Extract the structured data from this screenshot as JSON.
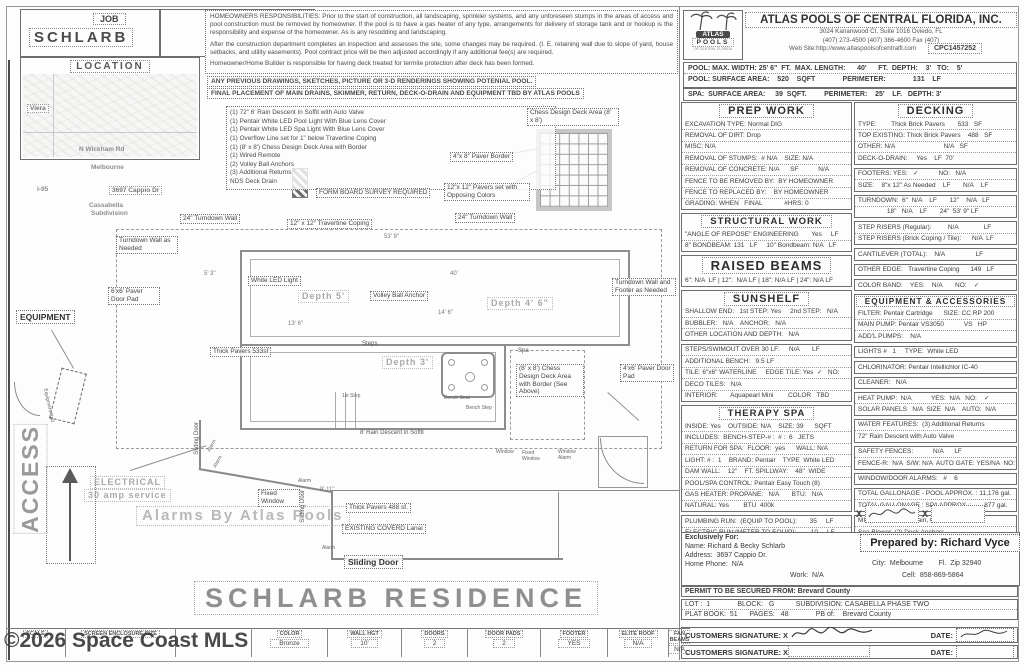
{
  "watermark": "©2026 Space Coast MLS",
  "header": {
    "job1": "JOB",
    "job_name": "SCHLARB",
    "job2": "JOB",
    "location": {
      "title": "LOCATION",
      "labels": [
        {
          "t": "Viera",
          "x": 4,
          "y": 30,
          "c": "map-box"
        },
        {
          "t": "N Wickham Rd",
          "x": 56,
          "y": 72
        },
        {
          "t": "Melbourne",
          "x": 68,
          "y": 90
        },
        {
          "t": "I-95",
          "x": 14,
          "y": 112
        },
        {
          "t": "3697 Cappio Dr",
          "x": 86,
          "y": 112,
          "c": "map-box"
        },
        {
          "t": "Cassabella",
          "x": 66,
          "y": 128
        },
        {
          "t": "Subdivision",
          "x": 68,
          "y": 136
        }
      ]
    },
    "resp": {
      "p1": "HOMEOWNERS RESPONSIBILITIES:  Prior to the start of construction, all landscaping, sprinkler systems, and any unforeseen stumps in the areas of access and pool construction must be removed by homeowner.  If the pool is to have a gas heater of any type, arrangements for delivery of storage tank and or hookup is the responsibility and expense of the homeowner.  As is any resodding and landscaping.",
      "p2": "After the construction department completes an inspection and assesses the site, some changes may be required.  (I. E. retaining wall due to slope of yard, house setbacks, and utility easements).  Pool contract price will be then adjusted accordingly if any additional fee(s) are required.",
      "p3": "Homeowner/Home Builder is responsible for having deck treated for termite protection after deck has been formed.",
      "n1": "ANY PREVIOUS DRAWINGS, SKETCHES, PICTURE OR 3-D RENDERINGS SHOWING POTENIAL POOL.",
      "n2": "FINAL PLACEMENT OF MAIN DRAINS, SKIMMER, RETURN, DECK-O-DRAIN AND EQUIPMENT TBD BY ATLAS POOLS"
    },
    "company": {
      "name": "ATLAS POOLS OF CENTRAL FLORIDA, INC.",
      "address": "3024 Kananwood Ct.  Suite 1016 Oviedo, FL",
      "phones": "(407) 273-4500  (407) 366-4600  Fax (407)",
      "website": "Web Site:http://www.atlaspoolsofcentralfl.com",
      "license": "CPC1457252",
      "logo_line1": "ATLAS",
      "logo_line2": "POOLS",
      "logo_sub": "OF CENTRAL FLORIDA"
    },
    "specs": {
      "rows": [
        "POOL: MAX. WIDTH: 25' 6\"  FT.  MAX. LENGTH:      40'      FT.  DEPTH:    3'   TO:    5'",
        "POOL: SURFACE AREA:    520    SQFT              PERIMETER:              131    LF",
        "SPA:  SURFACE AREA:     39  SQFT.         PERIMETER:    25'    LF.   DEPTH: 3'"
      ]
    }
  },
  "right": {
    "prep_work": {
      "title": "PREP WORK",
      "rows": [
        "EXCAVATION TYPE: Normal DIG",
        "REMOVAL OF DIRT: Drop",
        "MISC: N/A",
        "REMOVAL OF STUMPS:  # N/A    SIZE: N/A",
        "REMOVAL OF CONCRETE: N/A      SF           N/A",
        "FENCE TO BE REMOVED BY:  BY HOMEOWNER",
        "FENCE TO REPLACED BY:    BY HOMEOWNER",
        "GRADING: WHEN   FINAL            #HRS: 0"
      ]
    },
    "structural": {
      "title": "STRUCTURAL WORK",
      "rows": [
        "\"ANGLE OF REPOSE\" ENGINEERING       Yes     LF",
        "8\" BONDBEAM: 131   LF     10\" Bondbeam: N/A   LF"
      ]
    },
    "raised": {
      "title": "RAISED BEAMS",
      "rows": [
        "6\": N/A  LF | 12\":  N/A LF | 18\": N/A LF | 24\": N/A LF"
      ]
    },
    "sunshelf": {
      "title": "SUNSHELF",
      "rows": [
        "SHALLOW END:   1st STEP: Yes     2nd STEP:   N/A",
        "BUBBLER:   N/A    ANCHOR:   N/A",
        "OTHER LOCATION AND DEPTH:   N/A"
      ]
    },
    "pool_misc": {
      "rows": [
        "STEPS/SWIMOUT OVER 30 LF:     N/A       LF",
        "ADDITIONAL BENCH:   9.5 LF",
        "TILE: 6\"x6\" WATERLINE     EDGE TILE: Yes  ✓   NO:",
        "DECO TILES:   N/A",
        "INTERIOR:       Aquapearl Mini        COLOR   TBD"
      ]
    },
    "therapy": {
      "title": "THERAPY SPA",
      "rows": [
        "INSIDE: Yes    OUTSIDE: N/A    SIZE: 39      SQFT",
        "INCLUDES:  BENCH-STEP-# :  # :  6   JETS",
        "RETURN FOR SPA:  FLOOR:  yes      WALL: N/A",
        "LIGHT: # :  1    BRAND: Pentair    TYPE  White LED",
        "DAM WALL:    12\"    FT. SPILLWAY:    48\"  WIDE",
        "POOL/SPA CONTROL: Pentair Easy Touch (8)",
        "GAS HEATER: PROPANE:   N/A       BTU:   N/A",
        "NATURAL: Yes        BTU  400k"
      ]
    },
    "runs": {
      "rows": [
        "PLUMBING RUN:  (EQUIP TO POOL):       35     LF",
        "ELECTRIC RUN:(METER TO EQUIP):        10     LF"
      ]
    },
    "buyer": {
      "label": "BUYER PLEASE",
      "text": "BUYERS APPROVE THE SPECIFICATIONS AND THE EQUIPMENT",
      "x1": "X",
      "x2": "X"
    },
    "decking": {
      "title": "DECKING",
      "rows": [
        "TYPE:        Thick Brick Pavers       533   SF",
        "TOP EXISTING: Thick Brick Pavers    488   SF",
        "OTHER: N/A                           N/A   SF",
        "DECK-O-DRAIN:     Yes    LF  70'"
      ]
    },
    "footers": {
      "rows": [
        "FOOTERS: YES:   ✓           NO:   N/A",
        "SIZE:    8\"x 12\" As Needed    LF       N/A    LF"
      ]
    },
    "turndown": {
      "rows": [
        "TURNDOWN:  6\"  N/A    LF       12\"    N/A   LF",
        "                18\"   N/A    LF       24\"  53' 9\" LF"
      ]
    },
    "risers": {
      "rows": [
        "STEP RISERS (Regular):         N/A              LF",
        "STEP RISERS (Brick Coping / Tile):      N/A  LF"
      ]
    },
    "cant": {
      "rows": [
        "CANTILEVER (TOTAL):    N/A                 LF"
      ]
    },
    "edge": {
      "rows": [
        "OTHER EDGE:   Travertine Coping      149   LF"
      ]
    },
    "colorband": {
      "rows": [
        "COLOR BAND:    YES:    N/A       NO:    ✓"
      ]
    },
    "equip": {
      "title": "EQUIPMENT & ACCESSORIES",
      "rows": [
        "FILTER: Pentair Cartridge      SIZE: CC RP 200",
        "MAIN PUMP: Pentair VS3050           VS   HP",
        "ADD'L PUMPS:    N/A"
      ]
    },
    "lights": {
      "rows": [
        "LIGHTS #   1     TYPE:  White LED"
      ]
    },
    "chlor": {
      "rows": [
        "CHLORINATOR: Pentair Intellichlor IC-40"
      ]
    },
    "cleaner": {
      "rows": [
        "CLEANER:   N/A"
      ]
    },
    "heat": {
      "rows": [
        "HEAT PUMP:  N/A           YES:  N/A   NO:    ✓",
        "SOLAR PANELS   N/A  SIZE  N/A    AUTO:  N/A"
      ]
    },
    "water": {
      "rows": [
        "WATER FEATURES:  (3) Additional Returns",
        "72\" Rain Descent with Auto Valve"
      ]
    },
    "safety": {
      "rows": [
        "SAFETY FENCES:           N/A      LF",
        "FENCE-R:  N/A  S/W: N/A  AUTO GATE: YES/NA  NO: ✓"
      ]
    },
    "alarms": {
      "rows": [
        "WINDOW/DOOR ALARMS:   #    6"
      ]
    },
    "gallons": {
      "rows": [
        "TOTAL GALLONAGE - POOL APPROX. : 11,176 gal.",
        "TOTAL GALLONAGE : SPA APPROX. :       877 gal."
      ]
    },
    "misc": {
      "rows": [
        "MISC:    Overflow Drain, Chess Area",
        "Spa Blower, (2) Deck Anchors"
      ]
    },
    "prepared": "Prepared by: Richard Vyce"
  },
  "customer": {
    "exclusively": "Exclusively For:",
    "name": "Name: Richard & Becky Schlarb",
    "address": "Address:  3697 Cappio Dr.",
    "home_phone": "Home Phone:  N/A",
    "work": "Work:  N/A",
    "city": "City:  Melbourne        Fl.  Zip 32940",
    "cell": "Cell:  858-869-5864",
    "permit": "PERMIT TO BE SECURED FROM: Brevard County",
    "lot": "LOT :  1              BLOCK:   G           SUBDIVISION: CASABELLA PHASE TWO",
    "plat": "PLAT BOOK:  51      PAGES:   48              PB of:    Brevard County",
    "sig_label": "CUSTOMERS SIGNATURE: X",
    "date_label": "DATE:"
  },
  "strip": {
    "cells": [
      {
        "label": "SCALE",
        "value": ""
      },
      {
        "label": "SCREEN ENCLOSURE SIZE",
        "value": ""
      },
      {
        "label": "",
        "value": ""
      },
      {
        "label": "COLOR",
        "value": "Bronze"
      },
      {
        "label": "WALL HGT",
        "value": "10'"
      },
      {
        "label": "DOORS",
        "value": "2"
      },
      {
        "label": "DOOR PADS",
        "value": "2"
      },
      {
        "label": "FOOTER",
        "value": "YES"
      },
      {
        "label": "ELITE ROOF",
        "value": "N/A"
      },
      {
        "label": "FAN BEAMS",
        "value": "N/A"
      }
    ]
  },
  "drawing": {
    "notes": [
      "(1) 72\" 6' Rain Descent In Soffit with Auto Valve",
      "(1) Pentair White LED Pool Light With Blue Lens Cover",
      "(1) Pentair White LED Spa Light With Blue Lens Cover",
      "(1) Overflow Line set for 1\" below Travertine Coping",
      "(1) (8' x 8') Chess Design Deck Area with Border",
      "(1) Wired Remote",
      "(2) Volley Ball Anchors",
      "(3) Additional Returns",
      "NDS Deck Drain"
    ],
    "labels": [
      {
        "t": "FORM BOARD SURVEY REQUIRED",
        "x": 316,
        "y": 188,
        "c": "box"
      },
      {
        "t": "Chess Design Deck Area    (8' x 8')",
        "x": 527,
        "y": 108,
        "c": "box",
        "w": 86
      },
      {
        "t": "4\"x 8\" Paver Border",
        "x": 450,
        "y": 152,
        "c": "box"
      },
      {
        "t": "12\"x 12\" Pavers set with Opposing Colors",
        "x": 444,
        "y": 183,
        "c": "box",
        "w": 80
      },
      {
        "t": "24\" Turndown Wall",
        "x": 180,
        "y": 214,
        "c": "box"
      },
      {
        "t": "12\" x 12\" Travertine Coping",
        "x": 287,
        "y": 219,
        "c": "box"
      },
      {
        "t": "24\" Turndown Wall",
        "x": 455,
        "y": 213,
        "c": "box"
      },
      {
        "t": "Turndown Wall as Needed",
        "x": 116,
        "y": 236,
        "c": "box",
        "w": 56
      },
      {
        "t": "White LED Light",
        "x": 248,
        "y": 276,
        "c": "box"
      },
      {
        "t": "Depth 5'",
        "x": 298,
        "y": 290,
        "c": "gray-md"
      },
      {
        "t": "Depth 4' 6\"",
        "x": 487,
        "y": 297,
        "c": "gray-md"
      },
      {
        "t": "Depth 3'",
        "x": 382,
        "y": 356,
        "c": "gray-md"
      },
      {
        "t": "Steps",
        "x": 362,
        "y": 341,
        "c": "tiny"
      },
      {
        "t": "Thick Pavers 533sf",
        "x": 210,
        "y": 347,
        "c": "box"
      },
      {
        "t": "Volley Ball Anchor",
        "x": 370,
        "y": 291,
        "c": "box"
      },
      {
        "t": "Spa",
        "x": 518,
        "y": 348,
        "c": "tiny"
      },
      {
        "t": "(8' x 8') Chess Design Deck Area with Border (See Above)",
        "x": 516,
        "y": 364,
        "c": "box",
        "w": 62
      },
      {
        "t": "4'x6' Paver Door Pad",
        "x": 620,
        "y": 364,
        "c": "box",
        "w": 48
      },
      {
        "t": "6'x6' Paver Door Pad",
        "x": 108,
        "y": 287,
        "c": "box",
        "w": 46
      },
      {
        "t": "Turndown Wall and Footer as Needed",
        "x": 612,
        "y": 278,
        "c": "box",
        "w": 58
      },
      {
        "t": "8' Rain Descent in Soffit",
        "x": 360,
        "y": 430,
        "c": "tiny"
      },
      {
        "t": "EQUIPMENT",
        "x": 16,
        "y": 310,
        "c": "box-lg"
      },
      {
        "t": "ELECTRICAL",
        "x": 90,
        "y": 476,
        "c": "gray-md"
      },
      {
        "t": "30 amp service",
        "x": 84,
        "y": 489,
        "c": "gray-md"
      },
      {
        "t": "ACCESS",
        "x": 14,
        "y": 424,
        "c": "gray-xl vert"
      },
      {
        "t": "Alarms By Atlas Pools",
        "x": 136,
        "y": 506,
        "c": "gray-lg"
      },
      {
        "t": "SCHLARB RESIDENCE",
        "x": 194,
        "y": 581,
        "c": "gray-xxl"
      },
      {
        "t": "Sliding Door",
        "x": 194,
        "y": 422,
        "c": "tiny vert"
      },
      {
        "t": "Alarm",
        "x": 206,
        "y": 450,
        "c": "micro",
        "r": -60
      },
      {
        "t": "Alarm",
        "x": 212,
        "y": 466,
        "c": "micro",
        "r": -60
      },
      {
        "t": "Alarm",
        "x": 298,
        "y": 478,
        "c": "micro"
      },
      {
        "t": "Sliding Door",
        "x": 300,
        "y": 490,
        "c": "tiny vert"
      },
      {
        "t": "9' 11\"",
        "x": 320,
        "y": 487,
        "c": "dim"
      },
      {
        "t": "Thick Pavers 488 sf.",
        "x": 346,
        "y": 503,
        "c": "box"
      },
      {
        "t": "EXISTING COVERD  Lanai",
        "x": 342,
        "y": 524,
        "c": "box"
      },
      {
        "t": "Alarm",
        "x": 322,
        "y": 545,
        "c": "micro"
      },
      {
        "t": "Sliding Door",
        "x": 344,
        "y": 555,
        "c": "box-lg"
      },
      {
        "t": "Fixed Window",
        "x": 258,
        "y": 489,
        "c": "box",
        "w": 36
      },
      {
        "t": "Window",
        "x": 496,
        "y": 449,
        "c": "micro"
      },
      {
        "t": "Fixed Window",
        "x": 522,
        "y": 450,
        "c": "micro",
        "w": 26
      },
      {
        "t": "Window Alarm",
        "x": 558,
        "y": 449,
        "c": "micro",
        "w": 28
      },
      {
        "t": "53' 9\"",
        "x": 384,
        "y": 234,
        "c": "dim"
      },
      {
        "t": "40'",
        "x": 450,
        "y": 271,
        "c": "dim"
      },
      {
        "t": "5' 3\"",
        "x": 204,
        "y": 271,
        "c": "dim"
      },
      {
        "t": "13' 6\"",
        "x": 288,
        "y": 321,
        "c": "dim"
      },
      {
        "t": "14' 6\"",
        "x": 438,
        "y": 310,
        "c": "dim"
      },
      {
        "t": "Bench Seat",
        "x": 444,
        "y": 395,
        "c": "micro"
      },
      {
        "t": "Bench Step",
        "x": 466,
        "y": 405,
        "c": "micro"
      },
      {
        "t": "1st Step",
        "x": 342,
        "y": 393,
        "c": "micro"
      },
      {
        "t": "Equipment Pad",
        "x": 48,
        "y": 388,
        "c": "micro",
        "r": 78
      }
    ]
  }
}
